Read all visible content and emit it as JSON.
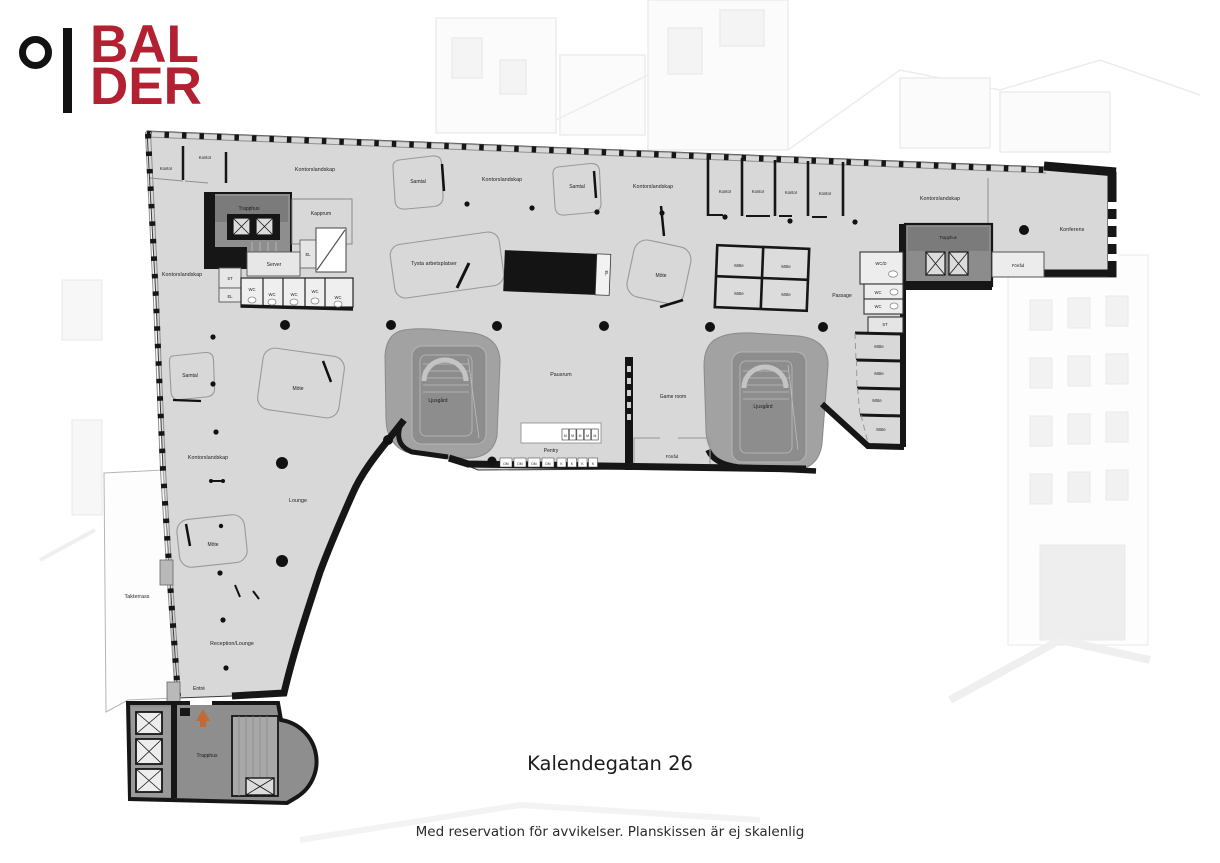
{
  "logo": {
    "line1": "BAL",
    "line2": "DER",
    "brand_color": "#b22032",
    "mark": "circle-and-bar"
  },
  "title": "Kalendegatan 26",
  "disclaimer": "Med reservation för avvikelser. Planskissen är ej skalenlig",
  "colors": {
    "wall": "#161616",
    "floor": "#d8d8d8",
    "stairwell_gray": "#8e8e8e",
    "atrium_gray": "#a2a2a2",
    "entrance_arrow_orange": "#c06a38",
    "brand_red": "#b22032"
  },
  "floor_plan": {
    "labels": {
      "kontor": "Kontor",
      "kontorslandskap": "Kontorslandskap",
      "trapphus": "Trapphus",
      "kapprum": "Kapprum",
      "server": "Server",
      "st": "ST",
      "el": "EL",
      "wc": "WC",
      "wcd": "WC/D",
      "samtal": "Samtal",
      "tysta": "Tysta arbetsplatser",
      "mote": "Möte",
      "konferens": "Konferens",
      "forrad": "Förråd",
      "passage": "Passage",
      "pausrum": "Pausrum",
      "ljusgard": "Ljusgård",
      "game_room": "Game room",
      "pentry": "Pentry",
      "lounge": "Lounge",
      "reception_lounge": "Reception/Lounge",
      "takterrass": "Takterrass",
      "entre": "Entré",
      "dm": "DM",
      "k": "K",
      "m": "M"
    }
  }
}
